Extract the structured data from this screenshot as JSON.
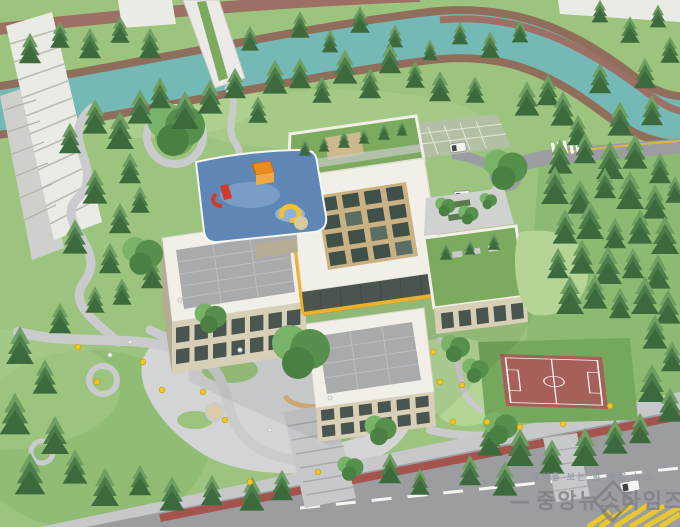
{
  "watermark": {
    "slogan": "개성을 보는 발 빠른 뉴스",
    "brand": "중앙뉴스타임즈",
    "dash": "—"
  },
  "palette": {
    "grass_base": "#9cc47f",
    "grass_light": "#b4d596",
    "grass_dark": "#74a85c",
    "conifer": "#4c7d4a",
    "conifer_light": "#6f9f62",
    "conifer_dark": "#3c6a3d",
    "broadleaf": "#57904d",
    "broadleaf_light": "#79b269",
    "river": "#74b9b6",
    "bank": "#8f6f5b",
    "trail": "#9e6f64",
    "road": "#9b9da0",
    "road_light": "#c6c8ca",
    "paver": "#c9cbcd",
    "plaza": "#d2d4d6",
    "bike_lane": "#a4534d",
    "court": "#a66059",
    "line_white": "#f5f5f2",
    "roof_white": "#f1efe7",
    "panel_roof": "#a8aaac",
    "wall": "#d8d0b6",
    "wall_dark": "#b5ac94",
    "glass": "#4a5550",
    "skylight_frame": "#c9b183",
    "skylight_glass": "#3f5048",
    "green_roof": "#7cab60",
    "playground": "#5f87b5",
    "play_red": "#cf3a2a",
    "play_orange": "#e98b1f",
    "play_yellow": "#eec32f",
    "canopy": "#ecb02a",
    "figure": "#f2c724",
    "van": "#f4f4f2",
    "hatch": "#e9c72f",
    "apartment": "#ebebe5",
    "apartment_shadow": "#cfd0cc",
    "watermark": "#7d8187"
  }
}
